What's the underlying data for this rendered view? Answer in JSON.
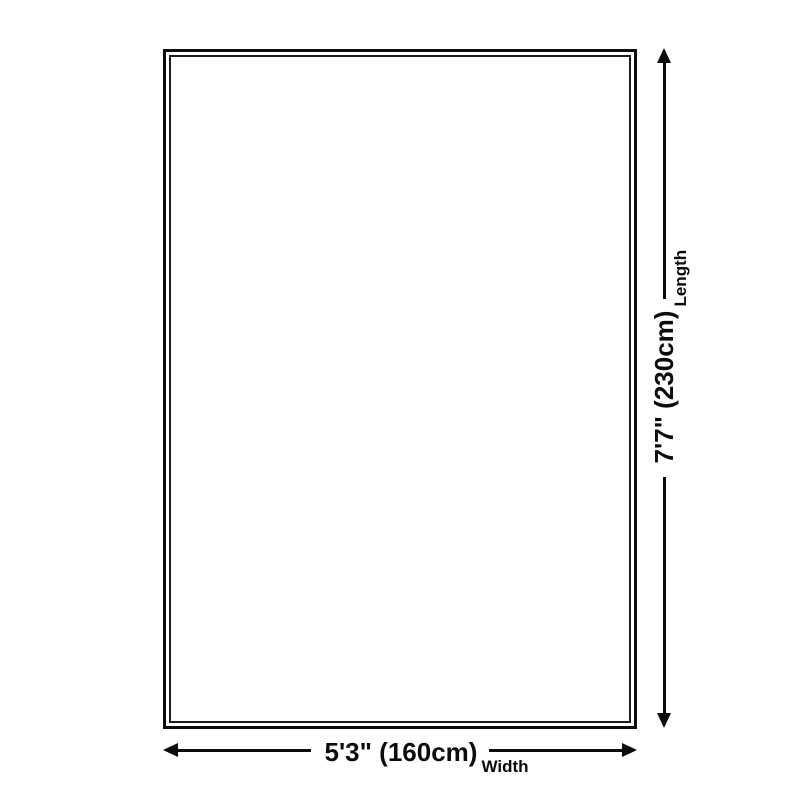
{
  "diagram": {
    "background_color": "#ffffff",
    "line_color": "#0c0c0c",
    "width": {
      "value": "5'3\" (160cm)",
      "label": "Width"
    },
    "length": {
      "value": "7'7\" (230cm)",
      "label": "Length"
    }
  }
}
